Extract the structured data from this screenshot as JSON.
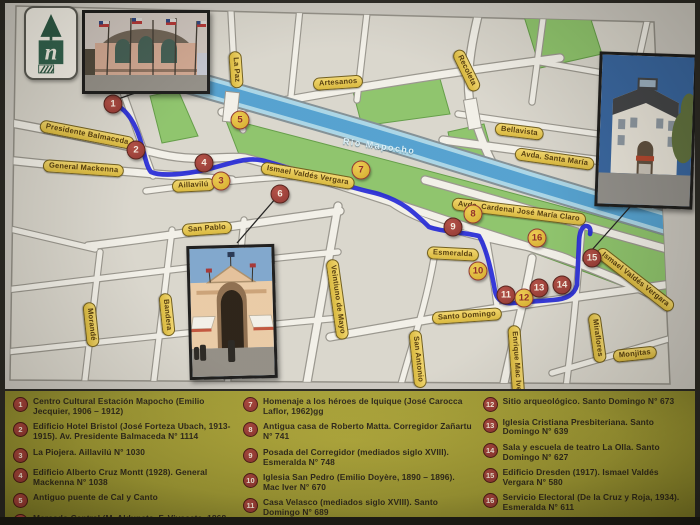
{
  "logo": {
    "letter": "n"
  },
  "map": {
    "river_label": {
      "text": "Río Mapocho",
      "x": 338,
      "y": 136,
      "rot": 8
    },
    "street_labels": [
      {
        "text": "Presidente Balmaceda",
        "x": 35,
        "y": 119,
        "rot": 11
      },
      {
        "text": "General Mackenna",
        "x": 38,
        "y": 159,
        "rot": 4
      },
      {
        "text": "Aillavilú",
        "x": 167,
        "y": 180,
        "rot": -3
      },
      {
        "text": "San Pablo",
        "x": 177,
        "y": 224,
        "rot": -4
      },
      {
        "text": "Morandé",
        "x": 84,
        "y": 296,
        "rot": 84
      },
      {
        "text": "Bandera",
        "x": 160,
        "y": 287,
        "rot": 84
      },
      {
        "text": "Veintiuno de Mayo",
        "x": 327,
        "y": 253,
        "rot": 82
      },
      {
        "text": "San Antonio",
        "x": 410,
        "y": 324,
        "rot": 84
      },
      {
        "text": "Santo Domingo",
        "x": 427,
        "y": 312,
        "rot": -4
      },
      {
        "text": "Enrique Mac Iver",
        "x": 509,
        "y": 319,
        "rot": 86
      },
      {
        "text": "Miraflores",
        "x": 589,
        "y": 307,
        "rot": 82
      },
      {
        "text": "Monjitas",
        "x": 608,
        "y": 350,
        "rot": -6
      },
      {
        "text": "Esmeralda",
        "x": 422,
        "y": 246,
        "rot": 3
      },
      {
        "text": "Ismael Valdés Vergara",
        "x": 256,
        "y": 161,
        "rot": 10
      },
      {
        "text": "Ismael Valdés Vergara",
        "x": 593,
        "y": 244,
        "rot": 38
      },
      {
        "text": "Artesanos",
        "x": 308,
        "y": 78,
        "rot": -4
      },
      {
        "text": "La Paz",
        "x": 230,
        "y": 45,
        "rot": 86
      },
      {
        "text": "Recoleta",
        "x": 452,
        "y": 44,
        "rot": 64
      },
      {
        "text": "Bellavista",
        "x": 490,
        "y": 122,
        "rot": 7
      },
      {
        "text": "Avda. Santa María",
        "x": 510,
        "y": 147,
        "rot": 8
      },
      {
        "text": "Avda. Cardenal José María Claro",
        "x": 447,
        "y": 197,
        "rot": 7
      }
    ],
    "markers": [
      {
        "n": "1",
        "x": 108,
        "y": 104,
        "variant": "red"
      },
      {
        "n": "2",
        "x": 131,
        "y": 150,
        "variant": "red"
      },
      {
        "n": "3",
        "x": 216,
        "y": 181,
        "variant": "yellow"
      },
      {
        "n": "4",
        "x": 199,
        "y": 163,
        "variant": "red"
      },
      {
        "n": "5",
        "x": 235,
        "y": 120,
        "variant": "yellow"
      },
      {
        "n": "6",
        "x": 275,
        "y": 194,
        "variant": "red"
      },
      {
        "n": "7",
        "x": 356,
        "y": 170,
        "variant": "yellow"
      },
      {
        "n": "8",
        "x": 468,
        "y": 214,
        "variant": "yellow"
      },
      {
        "n": "9",
        "x": 448,
        "y": 227,
        "variant": "red"
      },
      {
        "n": "10",
        "x": 473,
        "y": 271,
        "variant": "yellow"
      },
      {
        "n": "11",
        "x": 501,
        "y": 295,
        "variant": "red"
      },
      {
        "n": "12",
        "x": 519,
        "y": 298,
        "variant": "yellow"
      },
      {
        "n": "13",
        "x": 534,
        "y": 288,
        "variant": "red"
      },
      {
        "n": "14",
        "x": 557,
        "y": 285,
        "variant": "red"
      },
      {
        "n": "15",
        "x": 587,
        "y": 258,
        "variant": "red"
      },
      {
        "n": "16",
        "x": 532,
        "y": 238,
        "variant": "yellow"
      }
    ],
    "photos": [
      {
        "name": "estacion-mapocho-photo"
      },
      {
        "name": "mercado-central-photo"
      },
      {
        "name": "edificio-dresden-photo"
      }
    ]
  },
  "legend": {
    "columns": [
      [
        {
          "n": "1",
          "text": "Centro Cultural Estación Mapocho (Emilio Jecquier, 1906 – 1912)"
        },
        {
          "n": "2",
          "text": "Edificio Hotel Bristol (José Forteza Ubach, 1913-1915). Av. Presidente Balmaceda N° 1114"
        },
        {
          "n": "3",
          "text": "La Piojera. Aillavilú N° 1030"
        },
        {
          "n": "4",
          "text": "Edificio Alberto Cruz Montt (1928). General Mackenna N° 1038"
        },
        {
          "n": "5",
          "text": "Antiguo puente de Cal y Canto"
        },
        {
          "n": "6",
          "text": "Mercado Central (M. Aldunate, F. Vivaceta, 1868 – 1872)"
        }
      ],
      [
        {
          "n": "7",
          "text": "Homenaje a los héroes de Iquique (José Carocca Laflor, 1962)gg"
        },
        {
          "n": "8",
          "text": "Antigua casa de Roberto Matta. Corregidor Zañartu N° 741"
        },
        {
          "n": "9",
          "text": "Posada del Corregidor (mediados siglo XVIII). Esmeralda N° 748"
        },
        {
          "n": "10",
          "text": "Iglesia San Pedro (Emilio Doyère, 1890 – 1896). Mac Iver N° 670"
        },
        {
          "n": "11",
          "text": "Casa Velasco (mediados siglo XVIII). Santo Domingo N° 689"
        }
      ],
      [
        {
          "n": "12",
          "text": "Sitio arqueológico. Santo Domingo N° 673"
        },
        {
          "n": "13",
          "text": "Iglesia Cristiana Presbiteriana. Santo Domingo N° 639"
        },
        {
          "n": "14",
          "text": "Sala y escuela de teatro La Olla. Santo Domingo N° 627"
        },
        {
          "n": "15",
          "text": "Edificio Dresden (1917). Ismael Valdés Vergara N° 580"
        },
        {
          "n": "16",
          "text": "Servicio Electoral (De la Cruz y Roja, 1934). Esmeralda N° 611"
        }
      ]
    ]
  },
  "colors": {
    "route_blue": "#1b1fd6",
    "marker_red": "#8c2f2b",
    "marker_yellow": "#d0a622",
    "ribbon_gold": "#e2c149",
    "river_blue": "#4e9ecf",
    "park_green": "#8ac268",
    "legend_olive": "#a09a30"
  }
}
